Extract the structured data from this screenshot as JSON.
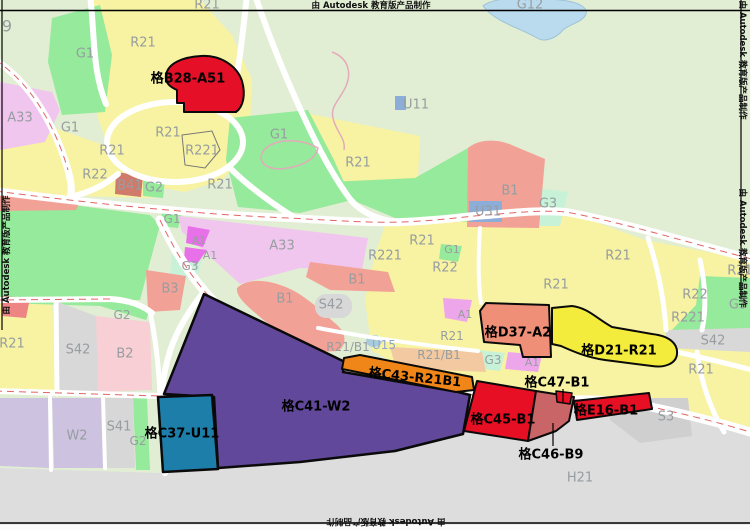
{
  "watermark_text": "由 Autodesk 教育版产品制作",
  "watermarks": [
    {
      "x": 371,
      "y": 5,
      "r": 0
    },
    {
      "x": 386,
      "y": 522,
      "r": 180
    },
    {
      "x": 6,
      "y": 255,
      "r": -90
    },
    {
      "x": 743,
      "y": 60,
      "r": 90
    },
    {
      "x": 743,
      "y": 248,
      "r": 90
    }
  ],
  "zone_labels": [
    {
      "t": "R21",
      "x": 207,
      "y": 4
    },
    {
      "t": "9",
      "x": 7,
      "y": 26,
      "s": 16
    },
    {
      "t": "G1",
      "x": 85,
      "y": 53
    },
    {
      "t": "R21",
      "x": 143,
      "y": 42
    },
    {
      "t": "G12",
      "x": 530,
      "y": 4
    },
    {
      "t": "U11",
      "x": 416,
      "y": 104
    },
    {
      "t": "A33",
      "x": 20,
      "y": 117
    },
    {
      "t": "G1",
      "x": 70,
      "y": 127
    },
    {
      "t": "R21",
      "x": 112,
      "y": 150
    },
    {
      "t": "R21",
      "x": 168,
      "y": 132
    },
    {
      "t": "R221",
      "x": 202,
      "y": 150
    },
    {
      "t": "R21",
      "x": 220,
      "y": 184
    },
    {
      "t": "G1",
      "x": 279,
      "y": 134
    },
    {
      "t": "R21",
      "x": 358,
      "y": 162
    },
    {
      "t": "R22",
      "x": 95,
      "y": 174
    },
    {
      "t": "B41",
      "x": 130,
      "y": 185
    },
    {
      "t": "G2",
      "x": 154,
      "y": 187
    },
    {
      "t": "G1",
      "x": 172,
      "y": 219,
      "s": 12
    },
    {
      "t": "A1",
      "x": 199,
      "y": 240,
      "s": 11
    },
    {
      "t": "A1",
      "x": 210,
      "y": 255,
      "s": 11
    },
    {
      "t": "A33",
      "x": 282,
      "y": 245
    },
    {
      "t": "G3",
      "x": 190,
      "y": 266,
      "s": 12
    },
    {
      "t": "B3",
      "x": 170,
      "y": 288
    },
    {
      "t": "B1",
      "x": 510,
      "y": 190
    },
    {
      "t": "U31",
      "x": 488,
      "y": 211
    },
    {
      "t": "G3",
      "x": 548,
      "y": 203
    },
    {
      "t": "R21",
      "x": 422,
      "y": 240
    },
    {
      "t": "G1",
      "x": 452,
      "y": 249,
      "s": 11
    },
    {
      "t": "R22",
      "x": 445,
      "y": 267
    },
    {
      "t": "R21",
      "x": 618,
      "y": 255
    },
    {
      "t": "R21",
      "x": 740,
      "y": 270
    },
    {
      "t": "B1",
      "x": 285,
      "y": 298
    },
    {
      "t": "S42",
      "x": 331,
      "y": 304
    },
    {
      "t": "B1",
      "x": 357,
      "y": 279
    },
    {
      "t": "R221",
      "x": 385,
      "y": 255
    },
    {
      "t": "R21",
      "x": 556,
      "y": 284
    },
    {
      "t": "R22",
      "x": 695,
      "y": 294
    },
    {
      "t": "R221",
      "x": 688,
      "y": 317
    },
    {
      "t": "G3",
      "x": 738,
      "y": 304
    },
    {
      "t": "S42",
      "x": 713,
      "y": 340
    },
    {
      "t": "R21",
      "x": 701,
      "y": 369
    },
    {
      "t": "R21",
      "x": 12,
      "y": 343
    },
    {
      "t": "S42",
      "x": 78,
      "y": 349
    },
    {
      "t": "B2",
      "x": 125,
      "y": 353
    },
    {
      "t": "G2",
      "x": 122,
      "y": 315,
      "s": 12
    },
    {
      "t": "W2",
      "x": 77,
      "y": 435
    },
    {
      "t": "S41",
      "x": 119,
      "y": 426
    },
    {
      "t": "G2",
      "x": 138,
      "y": 441,
      "s": 12
    },
    {
      "t": "R21/B1",
      "x": 348,
      "y": 347,
      "s": 12
    },
    {
      "t": "U15",
      "x": 384,
      "y": 345,
      "s": 12,
      "c": "#8fa6c9"
    },
    {
      "t": "R21",
      "x": 452,
      "y": 336,
      "s": 12
    },
    {
      "t": "R21/B1",
      "x": 439,
      "y": 355,
      "s": 12
    },
    {
      "t": "G3",
      "x": 493,
      "y": 360,
      "s": 12
    },
    {
      "t": "A1",
      "x": 532,
      "y": 362,
      "s": 11
    },
    {
      "t": "A1",
      "x": 465,
      "y": 314,
      "s": 11
    },
    {
      "t": "S3",
      "x": 666,
      "y": 416
    },
    {
      "t": "H21",
      "x": 580,
      "y": 477
    }
  ],
  "parcel_labels": [
    {
      "t": "格B28-A51",
      "x": 188,
      "y": 78
    },
    {
      "t": "格D37-A2",
      "x": 518,
      "y": 332
    },
    {
      "t": "格D21-R21",
      "x": 619,
      "y": 350
    },
    {
      "t": "格C47-B1",
      "x": 557,
      "y": 382
    },
    {
      "t": "格C43-R21B1",
      "x": 415,
      "y": 377,
      "rot": 6
    },
    {
      "t": "格C41-W2",
      "x": 316,
      "y": 406
    },
    {
      "t": "格C37-U11",
      "x": 182,
      "y": 433
    },
    {
      "t": "格C45-B1",
      "x": 503,
      "y": 419
    },
    {
      "t": "格E16-B1",
      "x": 606,
      "y": 410
    },
    {
      "t": "格C46-B9",
      "x": 551,
      "y": 454
    }
  ],
  "colors": {
    "label_gray": "#979da0",
    "highlight_red": "#e60f23",
    "parcel_purple": "#61489b",
    "parcel_teal": "#1d7ea9",
    "parcel_orange": "#f18618",
    "parcel_salmon": "#ef8f78",
    "highlight_yellow": "#f4ec3c",
    "zone_yellow": "#f7f3a2",
    "zone_green": "#95ea9b",
    "bg_pale_green": "#e1eed3"
  }
}
